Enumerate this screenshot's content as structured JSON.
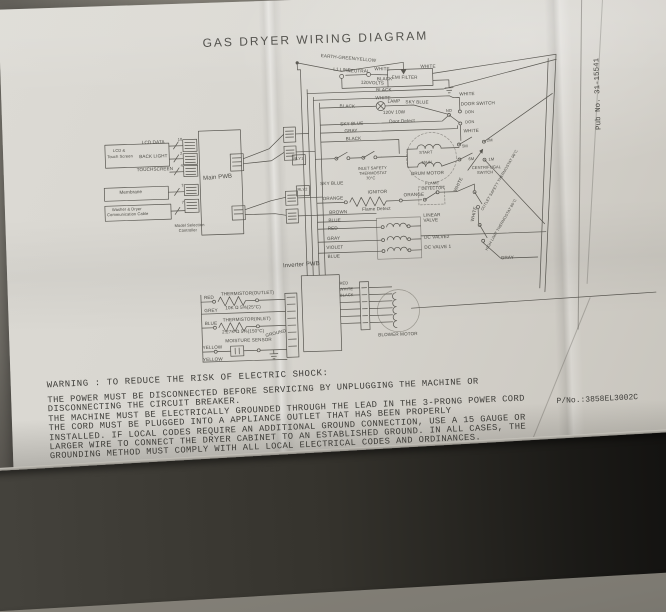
{
  "document": {
    "title": "GAS DRYER WIRING DIAGRAM",
    "part_number": "P/No.:3858EL3002C",
    "pub_number": "Pub No. 31-15541",
    "warning_heading": "WARNING : TO REDUCE THE RISK OF ELECTRIC SHOCK:",
    "warning_lines": [
      "THE POWER MUST BE DISCONNECTED BEFORE SERVICING BY UNPLUGGING THE MACHINE OR",
      "DISCONNECTING THE CIRCUIT BREAKER.",
      "THE MACHINE MUST BE ELECTRICALLY GROUNDED THROUGH THE LEAD IN THE 3-PRONG POWER CORD",
      "THE CORD MUST BE PLUGGED INTO A APPLIANCE OUTLET THAT HAS BEEN PROPERLY",
      "INSTALLED. IF LOCAL CODES REQUIRE AN ADDITIONAL GROUND CONNECTION, USE A 15 GAUGE OR",
      "LARGER WIRE TO CONNECT THE DRYER CABINET TO AN ESTABLISHED GROUND. IN ALL CASES, THE",
      "GROUNDING METHOD MUST COMPLY WITH ALL LOCAL ELECTRICAL CODES AND ORDINANCES."
    ]
  },
  "diagram": {
    "labels": [
      {
        "t": "EARTH-GREEN/YELLOW",
        "x": 321,
        "y": 55,
        "r": 7
      },
      {
        "t": "L1 LINE",
        "x": 333,
        "y": 69,
        "r": 5
      },
      {
        "t": "120VOLTS",
        "x": 360,
        "y": 83,
        "r": 4
      },
      {
        "t": "NEUTRAL",
        "x": 347,
        "y": 71,
        "r": 3
      },
      {
        "t": "WHITE",
        "x": 374,
        "y": 70,
        "r": 2
      },
      {
        "t": "BLACK",
        "x": 376,
        "y": 80,
        "r": 2
      },
      {
        "t": "EMI FILTER",
        "x": 391,
        "y": 79,
        "r": 2,
        "n": "emi-filter-label"
      },
      {
        "t": "WHITE",
        "x": 420,
        "y": 69,
        "r": 2
      },
      {
        "t": "BLACK",
        "x": 375,
        "y": 91,
        "r": 2
      },
      {
        "t": "WHITE",
        "x": 374,
        "y": 99,
        "r": 2
      },
      {
        "t": "WHITE",
        "x": 458,
        "y": 98
      },
      {
        "t": "BLACK",
        "x": 338,
        "y": 106,
        "r": 3
      },
      {
        "t": "LAMP",
        "x": 386,
        "y": 103
      },
      {
        "t": "120V 10W",
        "x": 381,
        "y": 114
      },
      {
        "t": "SKY BLUE",
        "x": 404,
        "y": 104,
        "r": 3
      },
      {
        "t": "DOOR SWITCH",
        "x": 459,
        "y": 108,
        "n": "door-switch-label"
      },
      {
        "t": "NO",
        "x": 444,
        "y": 114,
        "fs": 4
      },
      {
        "t": "DON",
        "x": 463,
        "y": 116,
        "fs": 4
      },
      {
        "t": "DON",
        "x": 463,
        "y": 126,
        "fs": 4
      },
      {
        "t": "SKY BLUE",
        "x": 338,
        "y": 124
      },
      {
        "t": "Door Detect",
        "x": 387,
        "y": 123
      },
      {
        "t": "GRAY",
        "x": 342,
        "y": 131
      },
      {
        "t": "WHITE",
        "x": 461,
        "y": 135
      },
      {
        "t": "BLACK",
        "x": 343,
        "y": 139
      },
      {
        "t": "5M",
        "x": 459,
        "y": 150,
        "fs": 4
      },
      {
        "t": "2M",
        "x": 484,
        "y": 145,
        "fs": 4
      },
      {
        "t": "6M",
        "x": 465,
        "y": 163,
        "fs": 4
      },
      {
        "t": "1M",
        "x": 485,
        "y": 164,
        "fs": 4
      },
      {
        "t": "CENTRIFUGAL",
        "x": 468,
        "y": 172,
        "fs": 4
      },
      {
        "t": "SWITCH",
        "x": 473,
        "y": 177,
        "fs": 4
      },
      {
        "t": "START",
        "x": 416,
        "y": 155,
        "fs": 4
      },
      {
        "t": "MAIN",
        "x": 418,
        "y": 165,
        "fs": 4
      },
      {
        "t": "DRUM MOTOR",
        "x": 407,
        "y": 176,
        "n": "drum-motor-label"
      },
      {
        "t": "INLET SAFETY",
        "x": 354,
        "y": 169,
        "fs": 4
      },
      {
        "t": "THERMOSTAT",
        "x": 355,
        "y": 174,
        "fs": 4
      },
      {
        "t": "70°C",
        "x": 362,
        "y": 179,
        "fs": 4
      },
      {
        "t": "SKY BLUE",
        "x": 316,
        "y": 183
      },
      {
        "t": "ORANGE",
        "x": 318,
        "y": 198
      },
      {
        "t": "IGNITOR",
        "x": 363,
        "y": 193,
        "n": "ignitor-label"
      },
      {
        "t": "ORANGE",
        "x": 399,
        "y": 197
      },
      {
        "t": "FLAME",
        "x": 421,
        "y": 186,
        "fs": 4
      },
      {
        "t": "DETECTOR",
        "x": 417,
        "y": 191,
        "fs": 4
      },
      {
        "t": "Flame Detect",
        "x": 357,
        "y": 210
      },
      {
        "t": "BROWN",
        "x": 324,
        "y": 212
      },
      {
        "t": "BLUE",
        "x": 323,
        "y": 220
      },
      {
        "t": "RED",
        "x": 322,
        "y": 228
      },
      {
        "t": "LINEAR",
        "x": 418,
        "y": 218
      },
      {
        "t": "VALVE",
        "x": 418,
        "y": 223
      },
      {
        "t": "GRAY",
        "x": 321,
        "y": 238
      },
      {
        "t": "DC VALVE2",
        "x": 418,
        "y": 240
      },
      {
        "t": "VIOLET",
        "x": 320,
        "y": 247
      },
      {
        "t": "DC VALVE 1",
        "x": 418,
        "y": 250
      },
      {
        "t": "BLUE",
        "x": 321,
        "y": 256
      },
      {
        "t": "WHITE",
        "x": 449,
        "y": 196,
        "r": -62
      },
      {
        "t": "OUTLET SAFETY THERMOSTAT 96°C",
        "x": 476,
        "y": 216,
        "r": -58,
        "fs": 3.8
      },
      {
        "t": "WHITE",
        "x": 465,
        "y": 227,
        "r": -75
      },
      {
        "t": "HIGH LIMIT THERMOSTAT 80°C",
        "x": 479,
        "y": 256,
        "r": -58,
        "fs": 3.8
      },
      {
        "t": "GRAY",
        "x": 494,
        "y": 263
      },
      {
        "t": "BLOWER MOTOR",
        "x": 369,
        "y": 336,
        "n": "blower-motor-label"
      },
      {
        "t": "RED",
        "x": 332,
        "y": 283,
        "fs": 4
      },
      {
        "t": "WHITE",
        "x": 332,
        "y": 289,
        "fs": 4
      },
      {
        "t": "BLACK",
        "x": 332,
        "y": 295,
        "fs": 4
      },
      {
        "t": "THERMISTOR(OUTLET)",
        "x": 213,
        "y": 290,
        "n": "thermistor-outlet-label"
      },
      {
        "t": "10K Ω 5%(25°C)",
        "x": 217,
        "y": 304
      },
      {
        "t": "RED",
        "x": 196,
        "y": 293
      },
      {
        "t": "GREY",
        "x": 196,
        "y": 306
      },
      {
        "t": "BLUE",
        "x": 196,
        "y": 319
      },
      {
        "t": "THERMISTOR(INLET)",
        "x": 214,
        "y": 316,
        "n": "thermistor-inlet-label"
      },
      {
        "t": "2.27K Ω 5%(150°C)",
        "x": 213,
        "y": 328
      },
      {
        "t": "MOISTURE SENSOR",
        "x": 216,
        "y": 337,
        "n": "moisture-sensor-label"
      },
      {
        "t": "YELLOW",
        "x": 193,
        "y": 343
      },
      {
        "t": "YELLOW",
        "x": 193,
        "y": 355
      },
      {
        "t": "GROUND",
        "x": 256,
        "y": 333,
        "r": -12
      },
      {
        "t": "LCD &",
        "x": 110,
        "y": 143,
        "fs": 4
      },
      {
        "t": "Touch Screen",
        "x": 104,
        "y": 149,
        "fs": 4
      },
      {
        "t": "LCD DATA",
        "x": 139,
        "y": 136
      },
      {
        "t": "BACK LIGHT",
        "x": 136,
        "y": 150
      },
      {
        "t": "TOUCHSCREEN",
        "x": 133,
        "y": 163
      },
      {
        "t": "Membrane",
        "x": 115,
        "y": 185
      },
      {
        "t": "Washer & Dryer",
        "x": 107,
        "y": 202,
        "fs": 4
      },
      {
        "t": "Communication Cable",
        "x": 102,
        "y": 207,
        "fs": 4
      },
      {
        "t": "Model Selection",
        "x": 169,
        "y": 220,
        "fs": 4
      },
      {
        "t": "Controller",
        "x": 173,
        "y": 225,
        "fs": 4
      },
      {
        "t": "Main PWB",
        "x": 199,
        "y": 173,
        "fs": 6,
        "r": -3,
        "n": "main-pwb-label"
      },
      {
        "t": "Inverter PWB",
        "x": 276,
        "y": 263,
        "fs": 6,
        "r": -2,
        "n": "inverter-pwb-label"
      },
      {
        "t": "10",
        "x": 175,
        "y": 134,
        "fs": 4
      },
      {
        "t": "2",
        "x": 177,
        "y": 148,
        "fs": 4
      },
      {
        "t": "4",
        "x": 177,
        "y": 160,
        "fs": 4
      },
      {
        "t": "7",
        "x": 177,
        "y": 180,
        "fs": 4
      },
      {
        "t": "7",
        "x": 177,
        "y": 197,
        "fs": 4
      },
      {
        "t": "RLY1",
        "x": 290,
        "y": 157,
        "fs": 4
      },
      {
        "t": "RLY2",
        "x": 293,
        "y": 188,
        "fs": 4
      }
    ]
  }
}
